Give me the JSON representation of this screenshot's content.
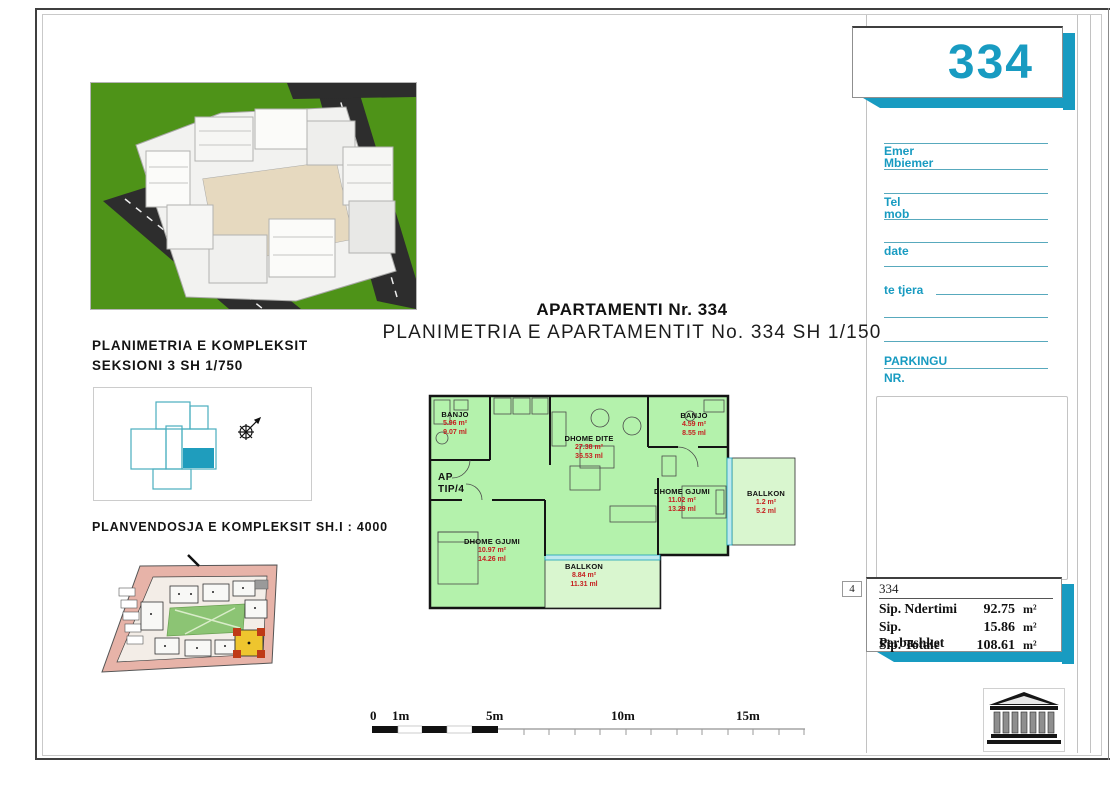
{
  "sheet": {
    "apartment_number": "334",
    "title": "APARTAMENTI Nr. 334",
    "subtitle": "PLANIMETRIA E APARTAMENTIT No. 334 SH 1/150"
  },
  "left_panel": {
    "complex_plan_label1": "PLANIMETRIA E KOMPLEKSIT",
    "complex_plan_label2": "SEKSIONI 3  SH 1/750",
    "site_plan_label": "PLANVENDOSJA E KOMPLEKSIT SH.I : 4000"
  },
  "form": {
    "emer": "Emer",
    "mbiemer": "Mbiemer",
    "tel": "Tel",
    "mob": "mob",
    "date": "date",
    "te_tjera": "te tjera",
    "parkingu": "PARKINGU",
    "nr": "NR."
  },
  "floor_plan": {
    "type_label1": "AP",
    "type_label2": "TIP/4",
    "rooms": [
      {
        "name": "BANJO",
        "area": "5.96 m²",
        "perimeter": "9.07 ml"
      },
      {
        "name": "DHOME DITE",
        "area": "27.38 m²",
        "perimeter": "36.53 ml"
      },
      {
        "name": "BANJO",
        "area": "4.59 m²",
        "perimeter": "8.55 ml"
      },
      {
        "name": "DHOME GJUMI",
        "area": "11.02 m²",
        "perimeter": "13.29 ml"
      },
      {
        "name": "BALLKON",
        "area": "1.2 m²",
        "perimeter": "5.2 ml"
      },
      {
        "name": "DHOME GJUMI",
        "area": "10.97 m²",
        "perimeter": "14.26 ml"
      },
      {
        "name": "BALLKON",
        "area": "8.84 m²",
        "perimeter": "11.31 ml"
      }
    ]
  },
  "summary": {
    "marker": "4",
    "apartment_id": "334",
    "rows": [
      {
        "label": "Sip. Ndertimi",
        "value": "92.75",
        "unit": "m²"
      },
      {
        "label": "Sip. Perbashket",
        "value": "15.86",
        "unit": "m²"
      },
      {
        "label": "Sip. Totale",
        "value": "108.61",
        "unit": "m²"
      }
    ]
  },
  "scale_bar": {
    "labels": [
      "0",
      "1m",
      "5m",
      "10m",
      "15m"
    ]
  },
  "colors": {
    "accent_teal": "#189bc1",
    "plan_fill_green": "#b4f2ac",
    "balcony_fill_green": "#d9f6cf",
    "area_text_red": "#c51f1f",
    "window_teal": "#18a0b8"
  }
}
